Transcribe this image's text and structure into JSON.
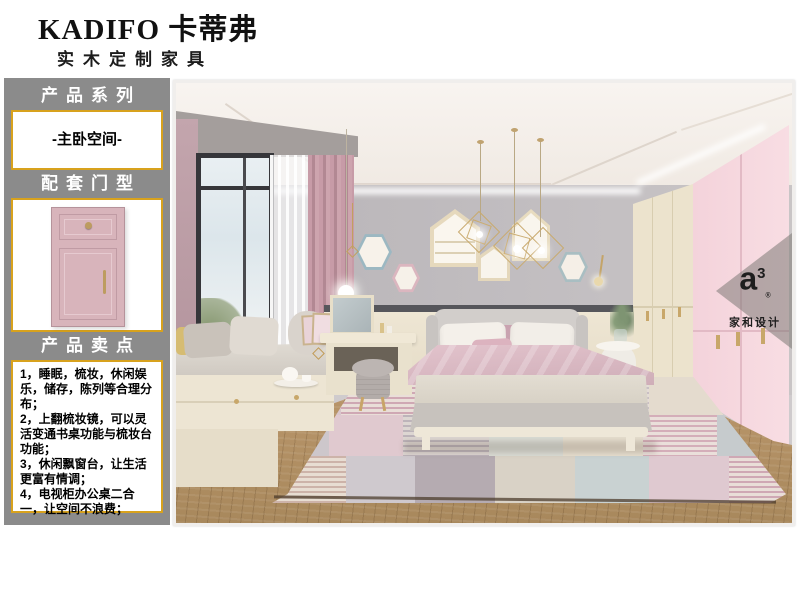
{
  "header": {
    "brand": "KADIFO 卡蒂弗",
    "subtitle": "实木定制家具"
  },
  "sidebar": {
    "series_title": "产品系列",
    "series_value": "-主卧空间-",
    "door_title": "配套门型",
    "selling_title": "产品卖点",
    "selling_points": [
      "1，睡眠，梳妆，休闲娱乐，储存，陈列等合理分布；",
      "2，上翻梳妆镜，可以灵活变通书桌功能与梳妆台功能；",
      "3，休闲飘窗台，让生活更富有情调；",
      "4，电视柜办公桌二合一，让空间不浪费；"
    ]
  },
  "photo": {
    "description": "master bedroom interior rendering",
    "watermark": {
      "logo": "a",
      "logo_sup": "3",
      "logo_reg": "®",
      "studio": "家和设计"
    }
  },
  "colors": {
    "accent_gold": "#D8A21D",
    "sidebar_gray": "#8B8B8B",
    "door_pink": "#D8B4BB",
    "wardrobe_pink": "#F6D8DF",
    "wardrobe_cream": "#ECE3CD",
    "curtain_pink": "#C49AA6",
    "wall_gray": "#BCB8BB",
    "wainscot_cream": "#EBE3D0",
    "floor_wood": "#B99569"
  }
}
